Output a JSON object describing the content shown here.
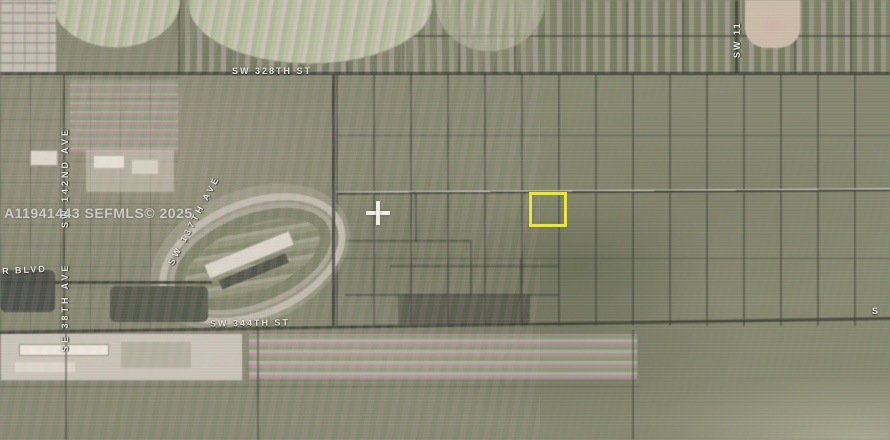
{
  "map": {
    "type": "aerial-parcel-map",
    "watermark": "A11941443 SEFMLS© 2025",
    "highlight_color": "#e9e73b",
    "labels": {
      "sw_328th_st": "SW 328TH ST",
      "sw_344th_st": "SW 344TH ST",
      "sw_142nd_ave": "SW 142ND AVE",
      "se_38th_ave": "SE 38TH AVE",
      "sw_137th_ave": "SW 137TH AVE",
      "sw_11_partial": "SW 11",
      "r_blvd_partial": "R BLVD",
      "s_partial": "S"
    },
    "features": {
      "subject_parcel": "yellow-outlined vacant lot south of mid road",
      "crosshair": "map center marker",
      "racetrack": "oval speedway with grandstands",
      "pivot_fields": "circular irrigated crop fields along top"
    }
  }
}
